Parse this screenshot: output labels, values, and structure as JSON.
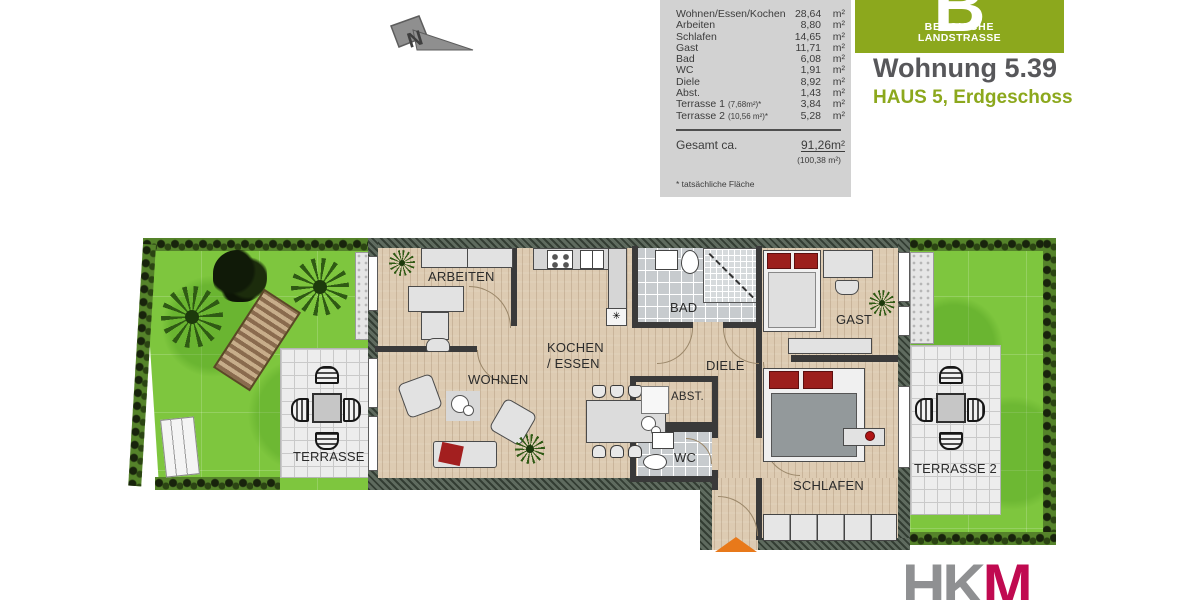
{
  "header": {
    "logo": {
      "letter": "B",
      "line1": "BERGISCHE",
      "line2": "LANDSTRASSE"
    },
    "title": "Wohnung 5.39",
    "subtitle": "HAUS 5, Erdgeschoss"
  },
  "north_label": "N",
  "area_table": {
    "rows": [
      {
        "label": "Wohnen/Essen/Kochen",
        "note": "",
        "value": "28,64",
        "unit": "m²"
      },
      {
        "label": "Arbeiten",
        "note": "",
        "value": "8,80",
        "unit": "m²"
      },
      {
        "label": "Schlafen",
        "note": "",
        "value": "14,65",
        "unit": "m²"
      },
      {
        "label": "Gast",
        "note": "",
        "value": "11,71",
        "unit": "m²"
      },
      {
        "label": "Bad",
        "note": "",
        "value": "6,08",
        "unit": "m²"
      },
      {
        "label": "WC",
        "note": "",
        "value": "1,91",
        "unit": "m²"
      },
      {
        "label": "Diele",
        "note": "",
        "value": "8,92",
        "unit": "m²"
      },
      {
        "label": "Abst.",
        "note": "",
        "value": "1,43",
        "unit": "m²"
      },
      {
        "label": "Terrasse 1",
        "note": "(7,68m²)*",
        "value": "3,84",
        "unit": "m²"
      },
      {
        "label": "Terrasse 2",
        "note": "(10,56 m²)*",
        "value": "5,28",
        "unit": "m²"
      }
    ],
    "total_label": "Gesamt ca.",
    "total_value": "91,26",
    "total_unit": "m²",
    "total_alt": "(100,38 m²)",
    "footnote": "* tatsächliche Fläche"
  },
  "plan": {
    "labels": {
      "arbeiten": "ARBEITEN",
      "wohnen": "WOHNEN",
      "kochen_line1": "KOCHEN",
      "kochen_line2": "/ ESSEN",
      "bad": "BAD",
      "diele": "DIELE",
      "gast": "GAST",
      "abst": "ABST.",
      "wc": "WC",
      "schlafen": "SCHLAFEN",
      "terrasse1": "TERRASSE 1",
      "terrasse2": "TERRASSE 2"
    },
    "symbols": {
      "dishwasher": "✳"
    }
  },
  "branding": {
    "hk": "HK",
    "m": "M"
  },
  "colors": {
    "logo_green": "#8ca81d",
    "hkm_magenta": "#c00a50",
    "entrance_orange": "#e8791a",
    "pillow_red": "#9c1f1c",
    "lawn_green": "#7ec63e",
    "table_bg": "#d2d2d2"
  }
}
